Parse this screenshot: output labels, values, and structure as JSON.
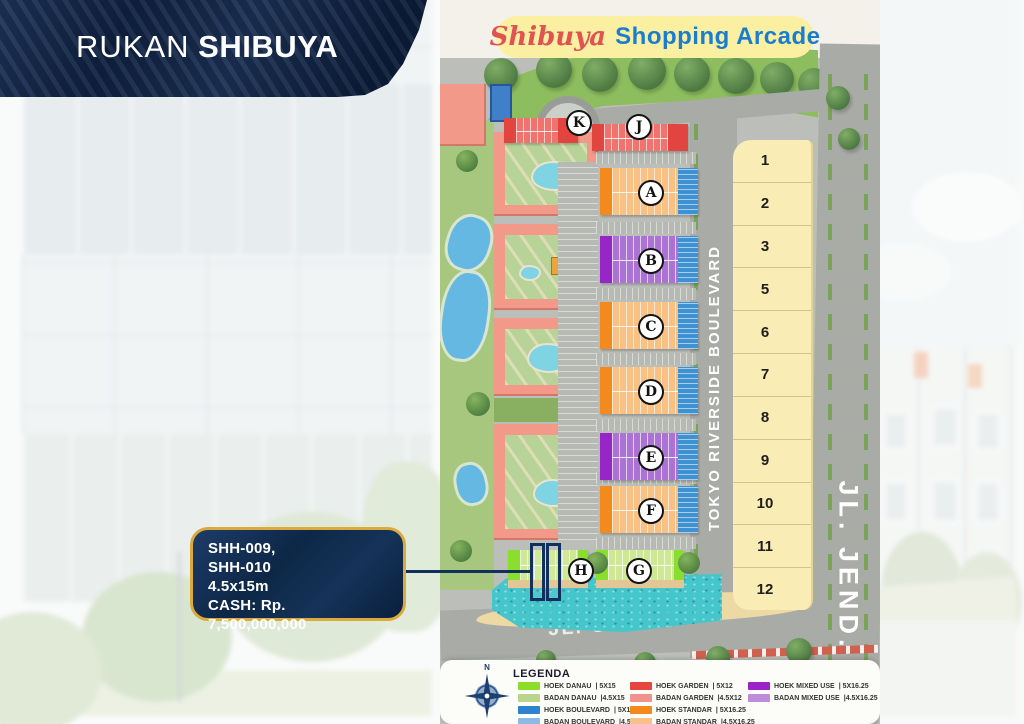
{
  "banner": {
    "title_light": "RUKAN",
    "title_bold": "SHIBUYA"
  },
  "map": {
    "title_script": "Shibuya",
    "title_rest": "Shopping Arcade",
    "road_boulevard": "TOKYO RIVERSIDE BOULEVARD",
    "road_right": "JL. JEND.",
    "road_bottom": "JL. OTISTA",
    "block_letters": {
      "a": "A",
      "b": "B",
      "c": "C",
      "d": "D",
      "e": "E",
      "f": "F",
      "g": "G",
      "h": "H",
      "j": "J",
      "k": "K"
    },
    "right_lots": [
      "1",
      "2",
      "3",
      "5",
      "6",
      "7",
      "8",
      "9",
      "10",
      "11",
      "12"
    ]
  },
  "callout": {
    "line1": "SHH-009,",
    "line2": "SHH-010",
    "line3": "4.5x15m",
    "line4": "CASH: Rp. 7,500,000,000"
  },
  "legend": {
    "title": "LEGENDA",
    "compass_label": "N",
    "columns": [
      {
        "items": [
          {
            "label": "HOEK DANAU",
            "size": "|  5X15",
            "color": "#8CDE2B"
          },
          {
            "label": "BADAN DANAU",
            "size": "|4.5X15",
            "color": "#B9D48C"
          },
          {
            "label": "HOEK BOULEVARD",
            "size": "|  5X15",
            "color": "#2E83CF"
          },
          {
            "label": "BADAN BOULEVARD",
            "size": "|4.5X15",
            "color": "#8BBAE4"
          }
        ]
      },
      {
        "items": [
          {
            "label": "HOEK GARDEN",
            "size": "|  5X12",
            "color": "#E64540"
          },
          {
            "label": "BADAN GARDEN",
            "size": "|4.5X12",
            "color": "#F2928E"
          },
          {
            "label": "HOEK STANDAR",
            "size": "|  5X16.25",
            "color": "#F48A1E"
          },
          {
            "label": "BADAN STANDAR",
            "size": "|4.5X16.25",
            "color": "#F8C189"
          }
        ]
      },
      {
        "items": [
          {
            "label": "HOEK MIXED USE",
            "size": "|  5X16.25",
            "color": "#9C22CC"
          },
          {
            "label": "BADAN MIXED USE",
            "size": "|4.5X16.25",
            "color": "#BE8CD8"
          }
        ]
      }
    ]
  },
  "colors": {
    "banner_navy": "#14294B",
    "callout_navy": "#10294D",
    "callout_gold": "#DCAA3C",
    "title_red": "#E05352",
    "title_blue": "#1A7ED0",
    "pill_yellow": "#FBF0A2"
  }
}
